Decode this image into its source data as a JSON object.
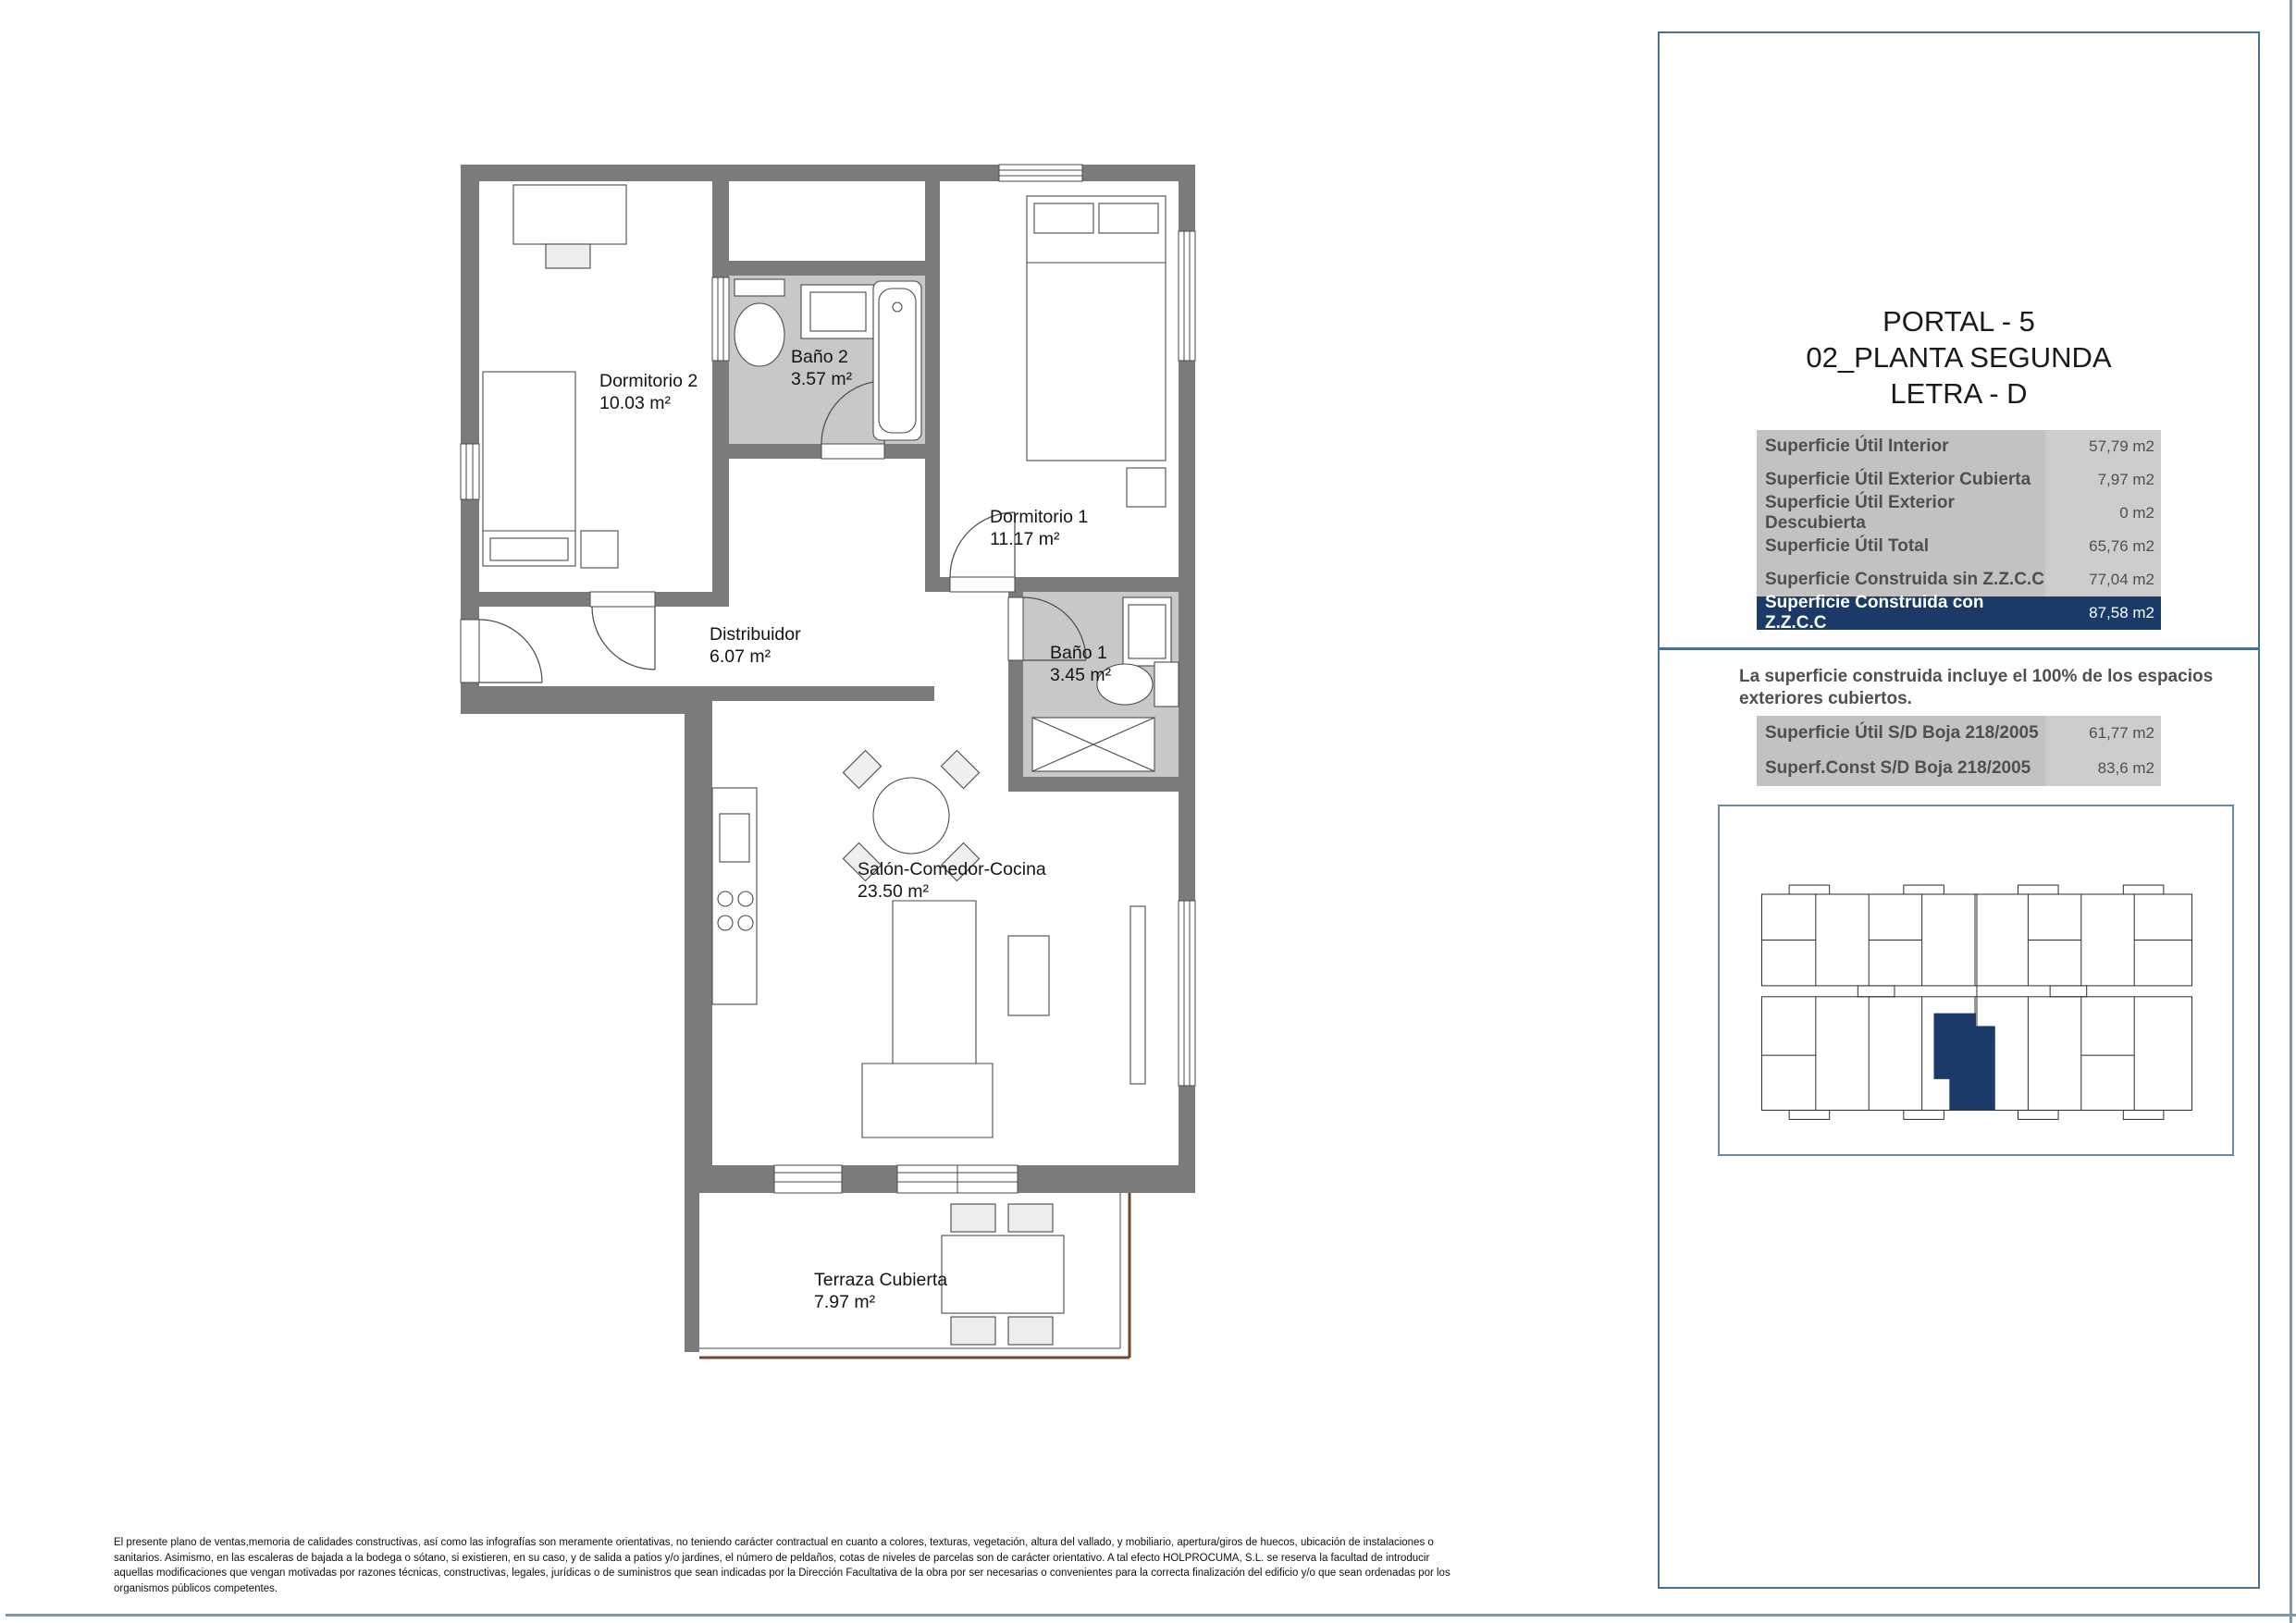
{
  "plan": {
    "rooms": [
      {
        "id": "dormitorio2",
        "name": "Dormitorio 2",
        "area": "10.03 m²"
      },
      {
        "id": "bano2",
        "name": "Baño 2",
        "area": "3.57 m²"
      },
      {
        "id": "dormitorio1",
        "name": "Dormitorio 1",
        "area": "11.17 m²"
      },
      {
        "id": "distribuidor",
        "name": "Distribuidor",
        "area": "6.07 m²"
      },
      {
        "id": "bano1",
        "name": "Baño 1",
        "area": "3.45 m²"
      },
      {
        "id": "salon",
        "name": "Salón-Comedor-Cocina",
        "area": "23.50 m²"
      },
      {
        "id": "terraza",
        "name": "Terraza Cubierta",
        "area": "7.97 m²"
      }
    ],
    "colors": {
      "wall": "#7b7b7b",
      "bathroom_floor": "#c8c8c8",
      "terrace_rail": "#74452e",
      "furniture_stroke": "#4a4a4a"
    }
  },
  "panel": {
    "title_lines": [
      "PORTAL - 5",
      "02_PLANTA SEGUNDA",
      "LETRA - D"
    ],
    "surface_table": {
      "rows": [
        {
          "label": "Superficie Útil Interior",
          "value": "57,79 m2"
        },
        {
          "label": "Superficie Útil Exterior Cubierta",
          "value": "7,97 m2"
        },
        {
          "label": "Superficie Útil Exterior Descubierta",
          "value": "0 m2"
        },
        {
          "label": "Superficie Útil Total",
          "value": "65,76 m2"
        },
        {
          "label": "Superficie Construida sin Z.Z.C.C",
          "value": "77,04 m2"
        },
        {
          "label": "Superficie Construida con Z.Z.C.C",
          "value": "87,58 m2"
        }
      ],
      "highlight_row_index": 5,
      "highlight_color": "#1b3a68"
    },
    "note": "La superficie construida incluye el 100% de los espacios exteriores cubiertos.",
    "boja_table": {
      "rows": [
        {
          "label": "Superficie Útil S/D Boja 218/2005",
          "value": "61,77 m2"
        },
        {
          "label": "Superf.Const S/D Boja 218/2005",
          "value": "83,6 m2"
        }
      ]
    },
    "keyplan": {
      "highlight_color": "#1b3a68",
      "border_color": "#6b8ba3"
    }
  },
  "disclaimer_lines": [
    "El presente plano de ventas,memoria de calidades constructivas, así como las infografías son meramente orientativas, no teniendo carácter contractual en cuanto a colores, texturas, vegetación, altura del vallado, y mobiliario, apertura/giros de huecos, ubicación de instalaciones o",
    "sanitarios. Asimismo, en las escaleras de bajada a la bodega o sótano, si existieren, en su caso, y de salida a patios y/o jardines, el número de peldaños, cotas de niveles de parcelas son de carácter orientativo. A tal efecto HOLPROCUMA, S.L.  se reserva la facultad de introducir",
    "aquellas modificaciones que vengan motivadas por razones técnicas, constructivas, legales, jurídicas o de suministros que sean indicadas por la Dirección Facultativa de la obra por ser necesarias o convenientes para la correcta finalización del edificio y/o que sean ordenadas por los",
    "organismos públicos competentes."
  ]
}
